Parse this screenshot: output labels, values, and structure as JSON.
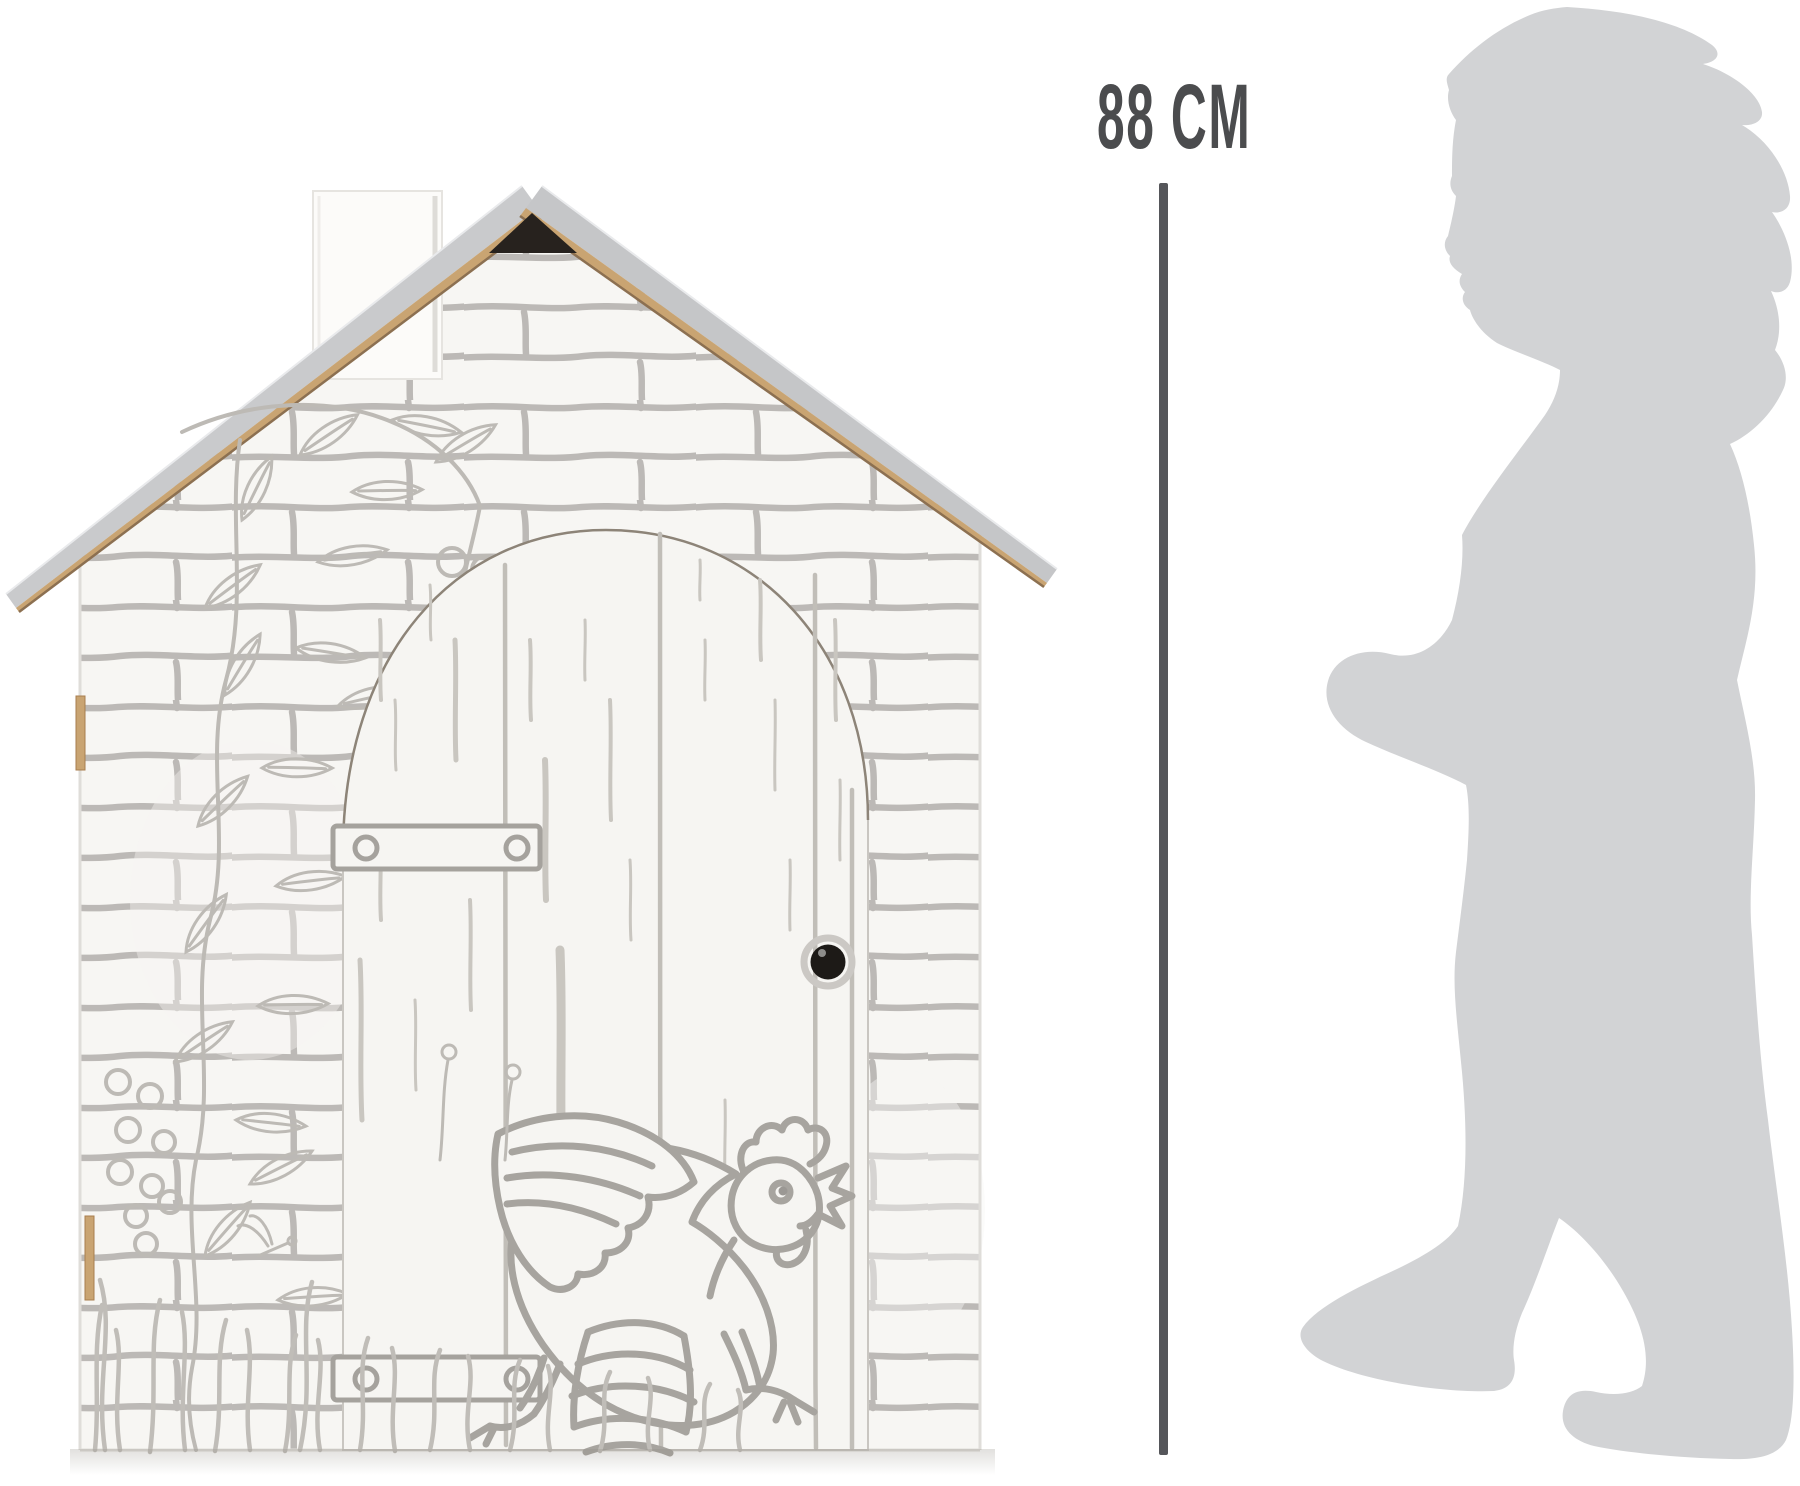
{
  "figure": {
    "height_label": "88 CM",
    "height_value_cm": 88
  },
  "colors": {
    "background": "#ffffff",
    "measure_line": "#55565a",
    "measure_text": "#4b4c4e",
    "silhouette": "#d2d3d5",
    "wall_white": "#f7f6f3",
    "door_white": "#f6f5f2",
    "sketch_gray": "#b5b2ae",
    "roof_gray": "#c9cacc",
    "cardboard_edge": "#c9a472",
    "roof_gap_dark": "#27221e",
    "knob_black": "#1d1a17"
  },
  "shapes": {
    "left_object": "cardboard-playhouse",
    "right_object": "child-silhouette"
  }
}
